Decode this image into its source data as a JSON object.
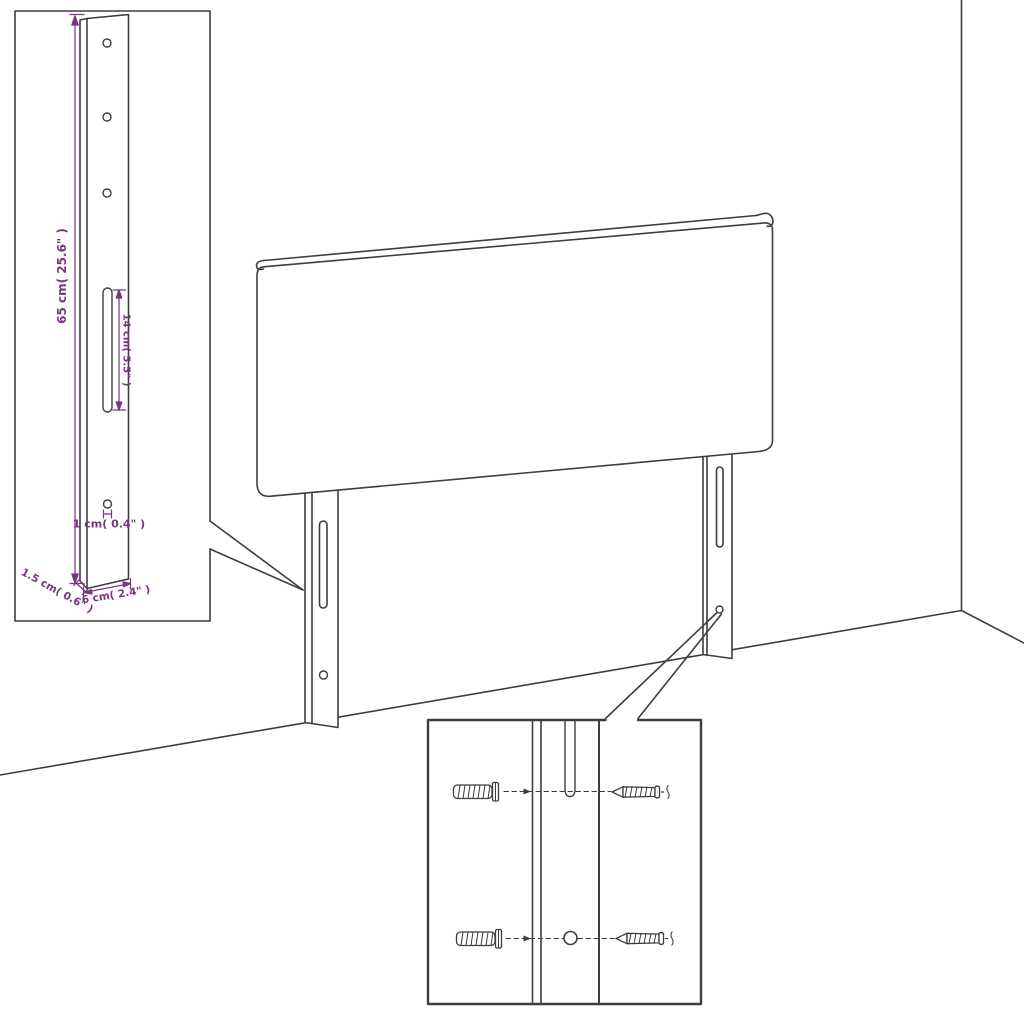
{
  "page": {
    "background": "#ffffff",
    "description": "Line-art assembly diagram of an upholstered headboard with two mounting legs, a magnified leg detail inset with dimensions, and a hardware inset showing wall plugs and screws"
  },
  "colors": {
    "line": "#3e3e3e",
    "dimension_accent": "#7b3382"
  },
  "detail_inset": {
    "dimensions": {
      "leg_height": "65 cm( 25.6\" )",
      "slot_length": "14 cm( 5.5\" )",
      "hole_diameter": "1 cm( 0.4\" )",
      "leg_thickness": "1.5 cm( 0.6\" )",
      "leg_width": "6 cm( 2.4\" )"
    }
  },
  "hardware_inset": {
    "parts": [
      "wall-plug",
      "wall-plug",
      "screw",
      "screw"
    ]
  }
}
